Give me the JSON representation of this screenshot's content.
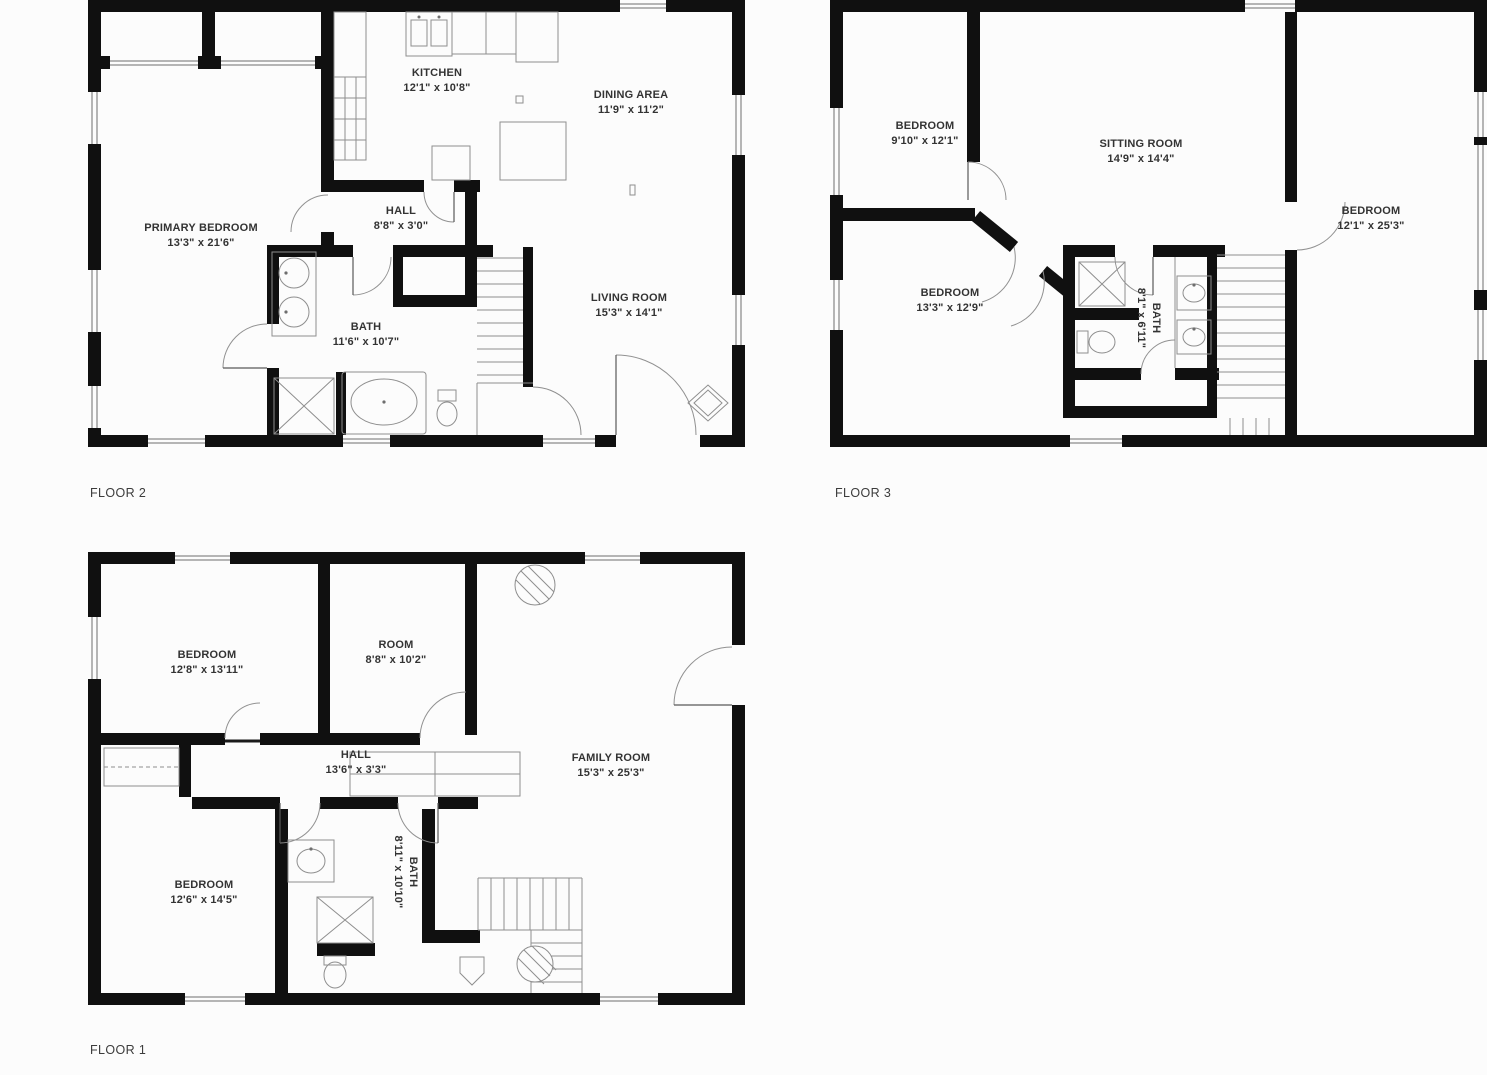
{
  "page": {
    "background": "#fcfcfc",
    "wall_color": "#101010",
    "line_color": "#8e8e8e",
    "label_color": "#333333"
  },
  "floors": [
    {
      "id": "floor-2",
      "label": "FLOOR 2",
      "rooms": [
        {
          "name": "KITCHEN",
          "dims": "12'1\" x 10'8\""
        },
        {
          "name": "DINING AREA",
          "dims": "11'9\" x 11'2\""
        },
        {
          "name": "PRIMARY BEDROOM",
          "dims": "13'3\" x 21'6\""
        },
        {
          "name": "HALL",
          "dims": "8'8\" x 3'0\""
        },
        {
          "name": "BATH",
          "dims": "11'6\" x 10'7\""
        },
        {
          "name": "LIVING ROOM",
          "dims": "15'3\" x 14'1\""
        }
      ]
    },
    {
      "id": "floor-3",
      "label": "FLOOR 3",
      "rooms": [
        {
          "name": "BEDROOM",
          "dims": "9'10\" x 12'1\""
        },
        {
          "name": "SITTING ROOM",
          "dims": "14'9\" x 14'4\""
        },
        {
          "name": "BEDROOM",
          "dims": "12'1\" x 25'3\""
        },
        {
          "name": "BEDROOM",
          "dims": "13'3\" x 12'9\""
        },
        {
          "name": "BATH",
          "dims": "8'1\" x 6'11\""
        }
      ]
    },
    {
      "id": "floor-1",
      "label": "FLOOR 1",
      "rooms": [
        {
          "name": "BEDROOM",
          "dims": "12'8\" x 13'11\""
        },
        {
          "name": "ROOM",
          "dims": "8'8\" x 10'2\""
        },
        {
          "name": "HALL",
          "dims": "13'6\" x 3'3\""
        },
        {
          "name": "FAMILY ROOM",
          "dims": "15'3\" x 25'3\""
        },
        {
          "name": "BEDROOM",
          "dims": "12'6\" x 14'5\""
        },
        {
          "name": "BATH",
          "dims": "8'11\" x 10'10\""
        }
      ]
    }
  ]
}
